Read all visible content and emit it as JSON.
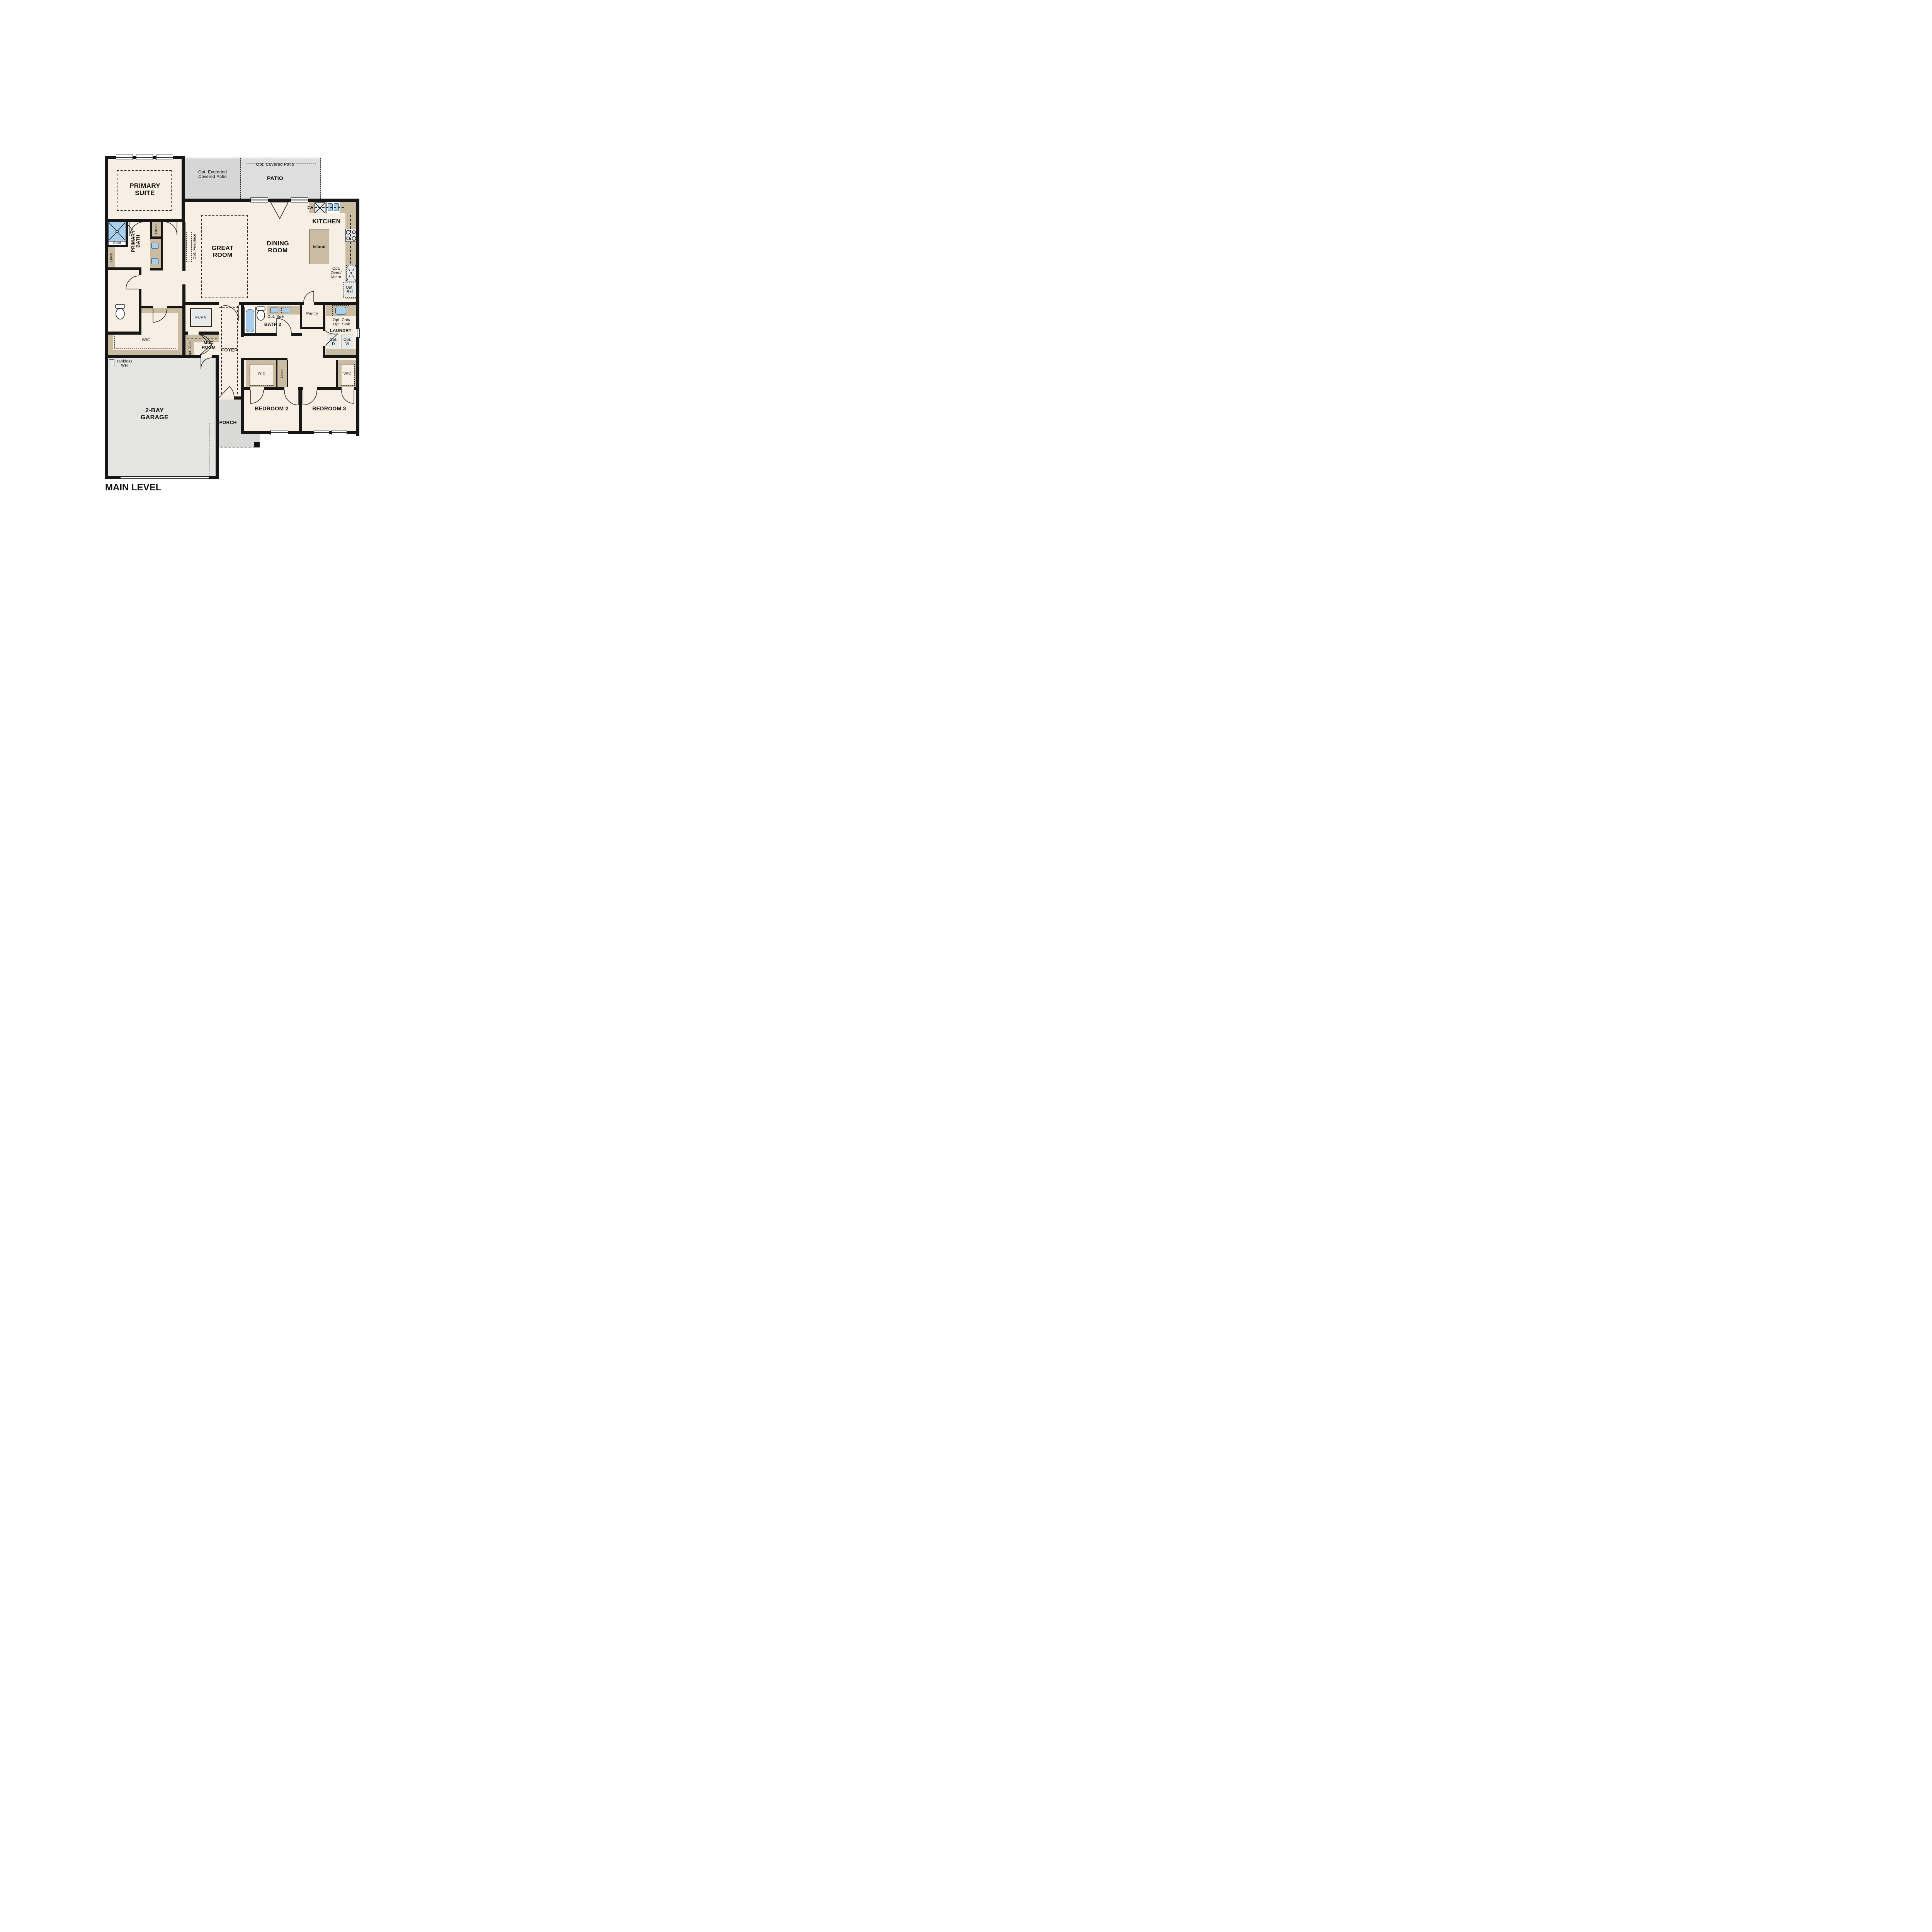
{
  "title": "MAIN LEVEL",
  "colors": {
    "room_fill": "#f7efe4",
    "casework_tan": "#c9bca2",
    "patio_gray": "#d6d6d6",
    "garage_gray": "#e4e4e2",
    "porch_gray": "#d9d9d7",
    "fixture_blue": "#a9cfec",
    "appliance_gray": "#e7eaea",
    "wall_black": "#161616"
  },
  "labels": {
    "primarySuite": "PRIMARY\nSUITE",
    "optExtPatio": "Opt. Extended\nCovered Patio",
    "optCoveredPatio": "Opt. Covered Patio",
    "patio": "PATIO",
    "greatRoom": "GREAT\nROOM",
    "diningRoom": "DINING\nROOM",
    "kitchen": "KITCHEN",
    "island": "Island",
    "dw": "DW",
    "optOvenMicro": "Opt.\nOven/\nMicro",
    "optRef": "Opt.\nRef",
    "optFireplace": "Opt. Fireplace",
    "primaryBath": "PRIMARY\nBATH",
    "seat": "Seat",
    "linenBathLeft": "Linen",
    "linenBathTop": "Linen",
    "wicPrimary": "WIC",
    "tanklessWH": "Tankless\nWH",
    "furn": "FURN",
    "mudRoom": "MUD\nROOM",
    "optValet": "Opt. Valet",
    "foyer": "FOYER",
    "porch": "PORCH",
    "bath2": "BATH 2",
    "optSink": "Opt. Sink",
    "pantry": "Pantry",
    "optCabOptSink": "Opt. Cab/\nOpt. Sink",
    "laundry": "LAUNDRY",
    "optD": "Opt.\nD",
    "optW": "Opt.\nW",
    "wicBed2": "WIC",
    "linenHall": "Linen",
    "wicBed3": "WIC",
    "bedroom2": "BEDROOM 2",
    "bedroom3": "BEDROOM 3",
    "mainLevel": "MAIN LEVEL",
    "garage": "2-BAY\nGARAGE"
  }
}
